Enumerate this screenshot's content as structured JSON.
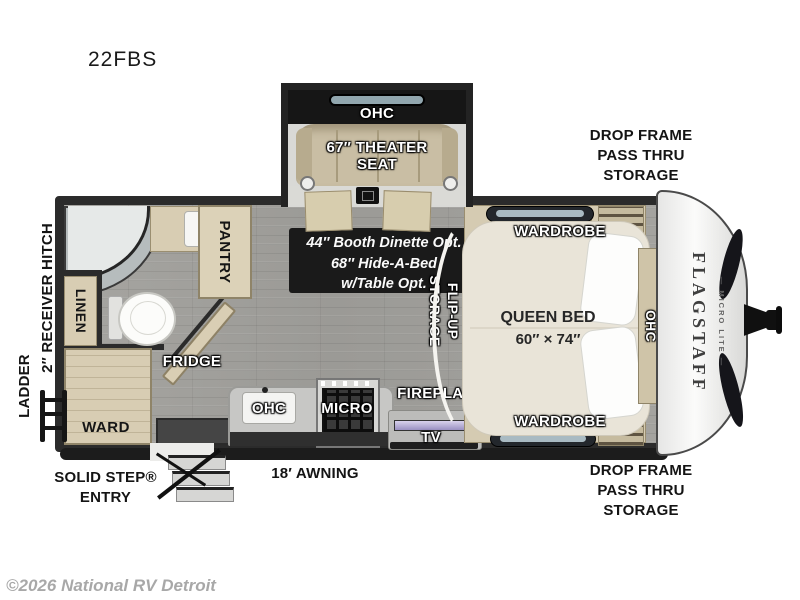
{
  "title": "22FBS",
  "copyright": "©2026 National RV Detroit",
  "colors": {
    "wall": "#2b2b2b",
    "floor_gray": "#a2a19d",
    "cabinet_beige": "#d8cdb3",
    "bed_beige": "#e9e4d8",
    "option_box_black": "#1a1a1a",
    "label_white": "#ffffff",
    "label_black": "#141414",
    "front_cap_white": "#f4f4f3",
    "copyright_gray": "#a8a8a8"
  },
  "exterior": {
    "drop_frame_top_line1": "DROP FRAME",
    "drop_frame_top_line2": "PASS THRU",
    "drop_frame_top_line3": "STORAGE",
    "drop_frame_bottom_line1": "DROP FRAME",
    "drop_frame_bottom_line2": "PASS THRU",
    "drop_frame_bottom_line3": "STORAGE",
    "awning": "18′ AWNING",
    "solid_step_line1": "SOLID STEP®",
    "solid_step_line2": "ENTRY",
    "ladder": "LADDER",
    "receiver_hitch": "2″ RECEIVER HITCH",
    "brand": "FLAGSTAFF",
    "brand_sub": "— MICRO LITE —"
  },
  "slideout": {
    "ohc": "OHC",
    "seat_line1": "67″ THEATER",
    "seat_line2": "SEAT"
  },
  "interior": {
    "dinette_line1": "44″ Booth Dinette Opt.",
    "dinette_line2": "68″ Hide-A-Bed",
    "dinette_line3": "w/Table Opt.",
    "pantry": "PANTRY",
    "linen": "LINEN",
    "ward": "WARD",
    "fridge": "FRIDGE",
    "kitchen_ohc": "OHC",
    "micro": "MICRO",
    "fireplace": "FIREPLACE",
    "tv": "TV",
    "flip_line1": "FLIP-UP",
    "flip_line2": "STORAGE",
    "bed_line1": "QUEEN BED",
    "bed_line2": "60″ × 74″",
    "wardrobe_top": "WARDROBE",
    "wardrobe_bottom": "WARDROBE",
    "bed_ohc": "OHC"
  }
}
